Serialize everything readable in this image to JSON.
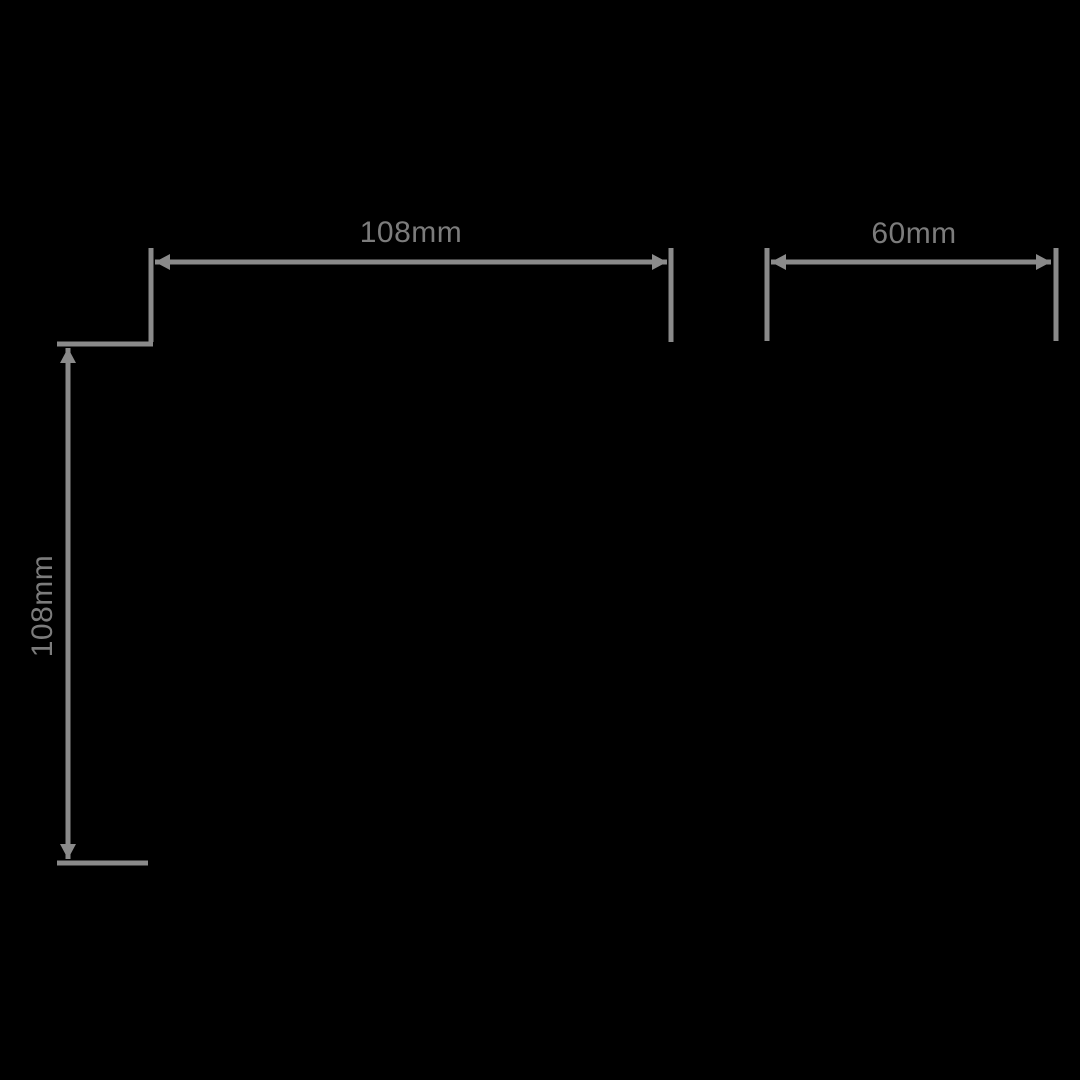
{
  "diagram": {
    "background": "#000000",
    "line_color": "#8a8a8a",
    "text_color": "#7c7c7c",
    "stroke_width": 5,
    "arrow": {
      "length": 15,
      "half_width": 8
    },
    "dimensions": [
      {
        "id": "front-width",
        "label": "108mm",
        "orientation": "horizontal",
        "line": {
          "x1": 155,
          "y1": 262,
          "x2": 667,
          "y2": 262
        },
        "extensions": [
          {
            "x1": 151,
            "y1": 248,
            "x2": 151,
            "y2": 342
          },
          {
            "x1": 671,
            "y1": 248,
            "x2": 671,
            "y2": 342
          }
        ],
        "label_anchor": {
          "x": 411,
          "y": 233
        }
      },
      {
        "id": "side-width",
        "label": "60mm",
        "orientation": "horizontal",
        "line": {
          "x1": 771,
          "y1": 262,
          "x2": 1051,
          "y2": 262
        },
        "extensions": [
          {
            "x1": 767,
            "y1": 248,
            "x2": 767,
            "y2": 341
          },
          {
            "x1": 1056,
            "y1": 248,
            "x2": 1056,
            "y2": 341
          }
        ],
        "label_anchor": {
          "x": 914,
          "y": 234
        }
      },
      {
        "id": "front-height",
        "label": "108mm",
        "orientation": "vertical",
        "line": {
          "x1": 68,
          "y1": 348,
          "x2": 68,
          "y2": 859
        },
        "extensions": [
          {
            "x1": 57,
            "y1": 344,
            "x2": 153,
            "y2": 344
          },
          {
            "x1": 57,
            "y1": 863,
            "x2": 148,
            "y2": 863
          }
        ],
        "label_anchor": {
          "x": 43,
          "y": 606
        }
      }
    ]
  }
}
